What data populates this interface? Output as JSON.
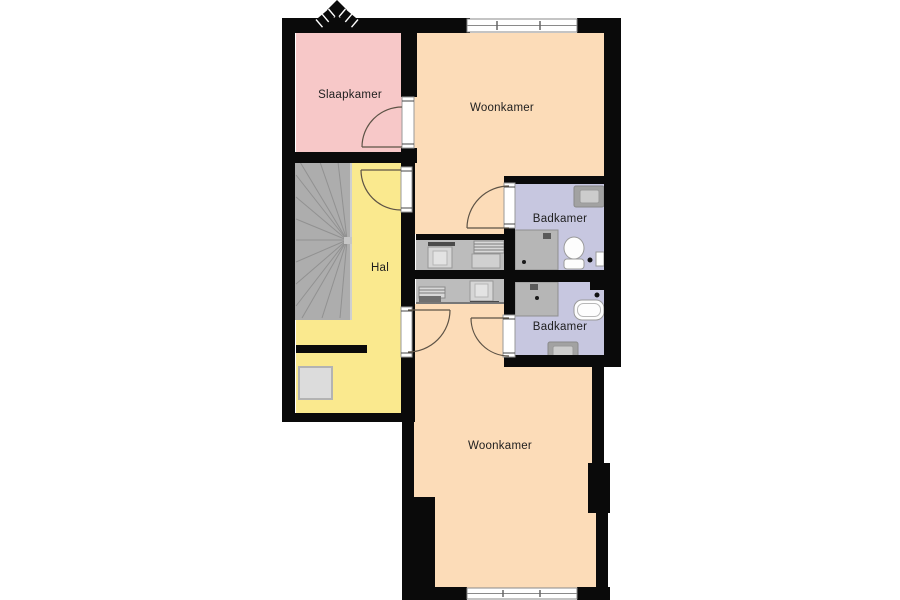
{
  "plan": {
    "type": "floorplan",
    "colors": {
      "background": "#ffffff",
      "wall": "#0a0a0a",
      "door_swing": "#5d5346",
      "window_frame": "#8a8a8a",
      "stairs": "#adadad",
      "stairs_tread": "#919191",
      "closet": "#bcbcbc",
      "shower": "#b6b6b6",
      "fixture_white": "#fdfdfd",
      "mat": "#dcdcdc"
    },
    "rooms": [
      {
        "id": "slaapkamer",
        "name": "Slaapkamer",
        "color": "#f7c8c8"
      },
      {
        "id": "woonkamer-boven",
        "name": "Woonkamer",
        "color": "#fcdcb8"
      },
      {
        "id": "hal",
        "name": "Hal",
        "color": "#fae98e"
      },
      {
        "id": "badkamer-boven",
        "name": "Badkamer",
        "color": "#c7c7e0"
      },
      {
        "id": "badkamer-onder",
        "name": "Badkamer",
        "color": "#c7c7e0"
      },
      {
        "id": "woonkamer-onder",
        "name": "Woonkamer",
        "color": "#fcdcb8"
      }
    ],
    "fixtures": [
      "staircase",
      "entrance-mat",
      "washer",
      "shelving",
      "shower",
      "toilet",
      "washbasin",
      "bathtub",
      "radiator"
    ],
    "features": [
      "chimney",
      "window-top",
      "window-bottom",
      "door-swings"
    ]
  }
}
